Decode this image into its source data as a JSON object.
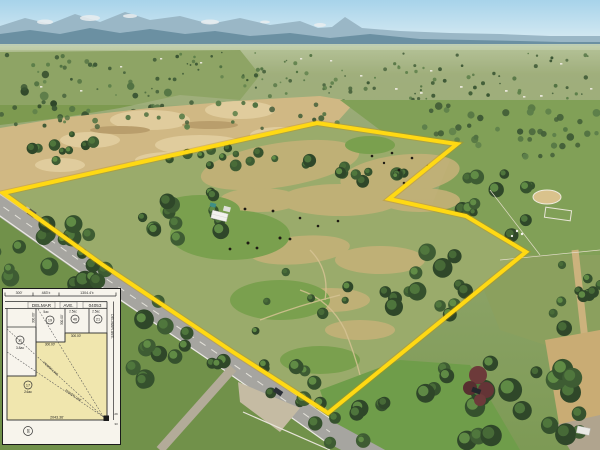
{
  "overlay": {
    "boundary_color": "#ffd913",
    "boundary_shadow_color": "#c79000"
  },
  "inset": {
    "top_dims": [
      "300'",
      "483'±",
      "1304.4'±"
    ],
    "street": {
      "h1": "DELMAR",
      "h2": "AVE.",
      "map_no": "04053",
      "v": "DELMAR AVE."
    },
    "parcels": [
      {
        "number": "11",
        "acreage": "3.8ac"
      },
      {
        "number": "19",
        "acreage": "5ac"
      },
      {
        "number": "46",
        "acreage": "2.5ac"
      },
      {
        "number": "21",
        "acreage": "2.5ac"
      },
      {
        "number": "17",
        "acreage": "24ac"
      }
    ],
    "corner_marker": "06",
    "bottom_dim": "2043.36'",
    "dims300": [
      "300.00'",
      "300.00'",
      "300.00'",
      "300.00'"
    ],
    "easement_label": "POWER LINE",
    "corner_ticks": [
      "29",
      "33"
    ]
  }
}
